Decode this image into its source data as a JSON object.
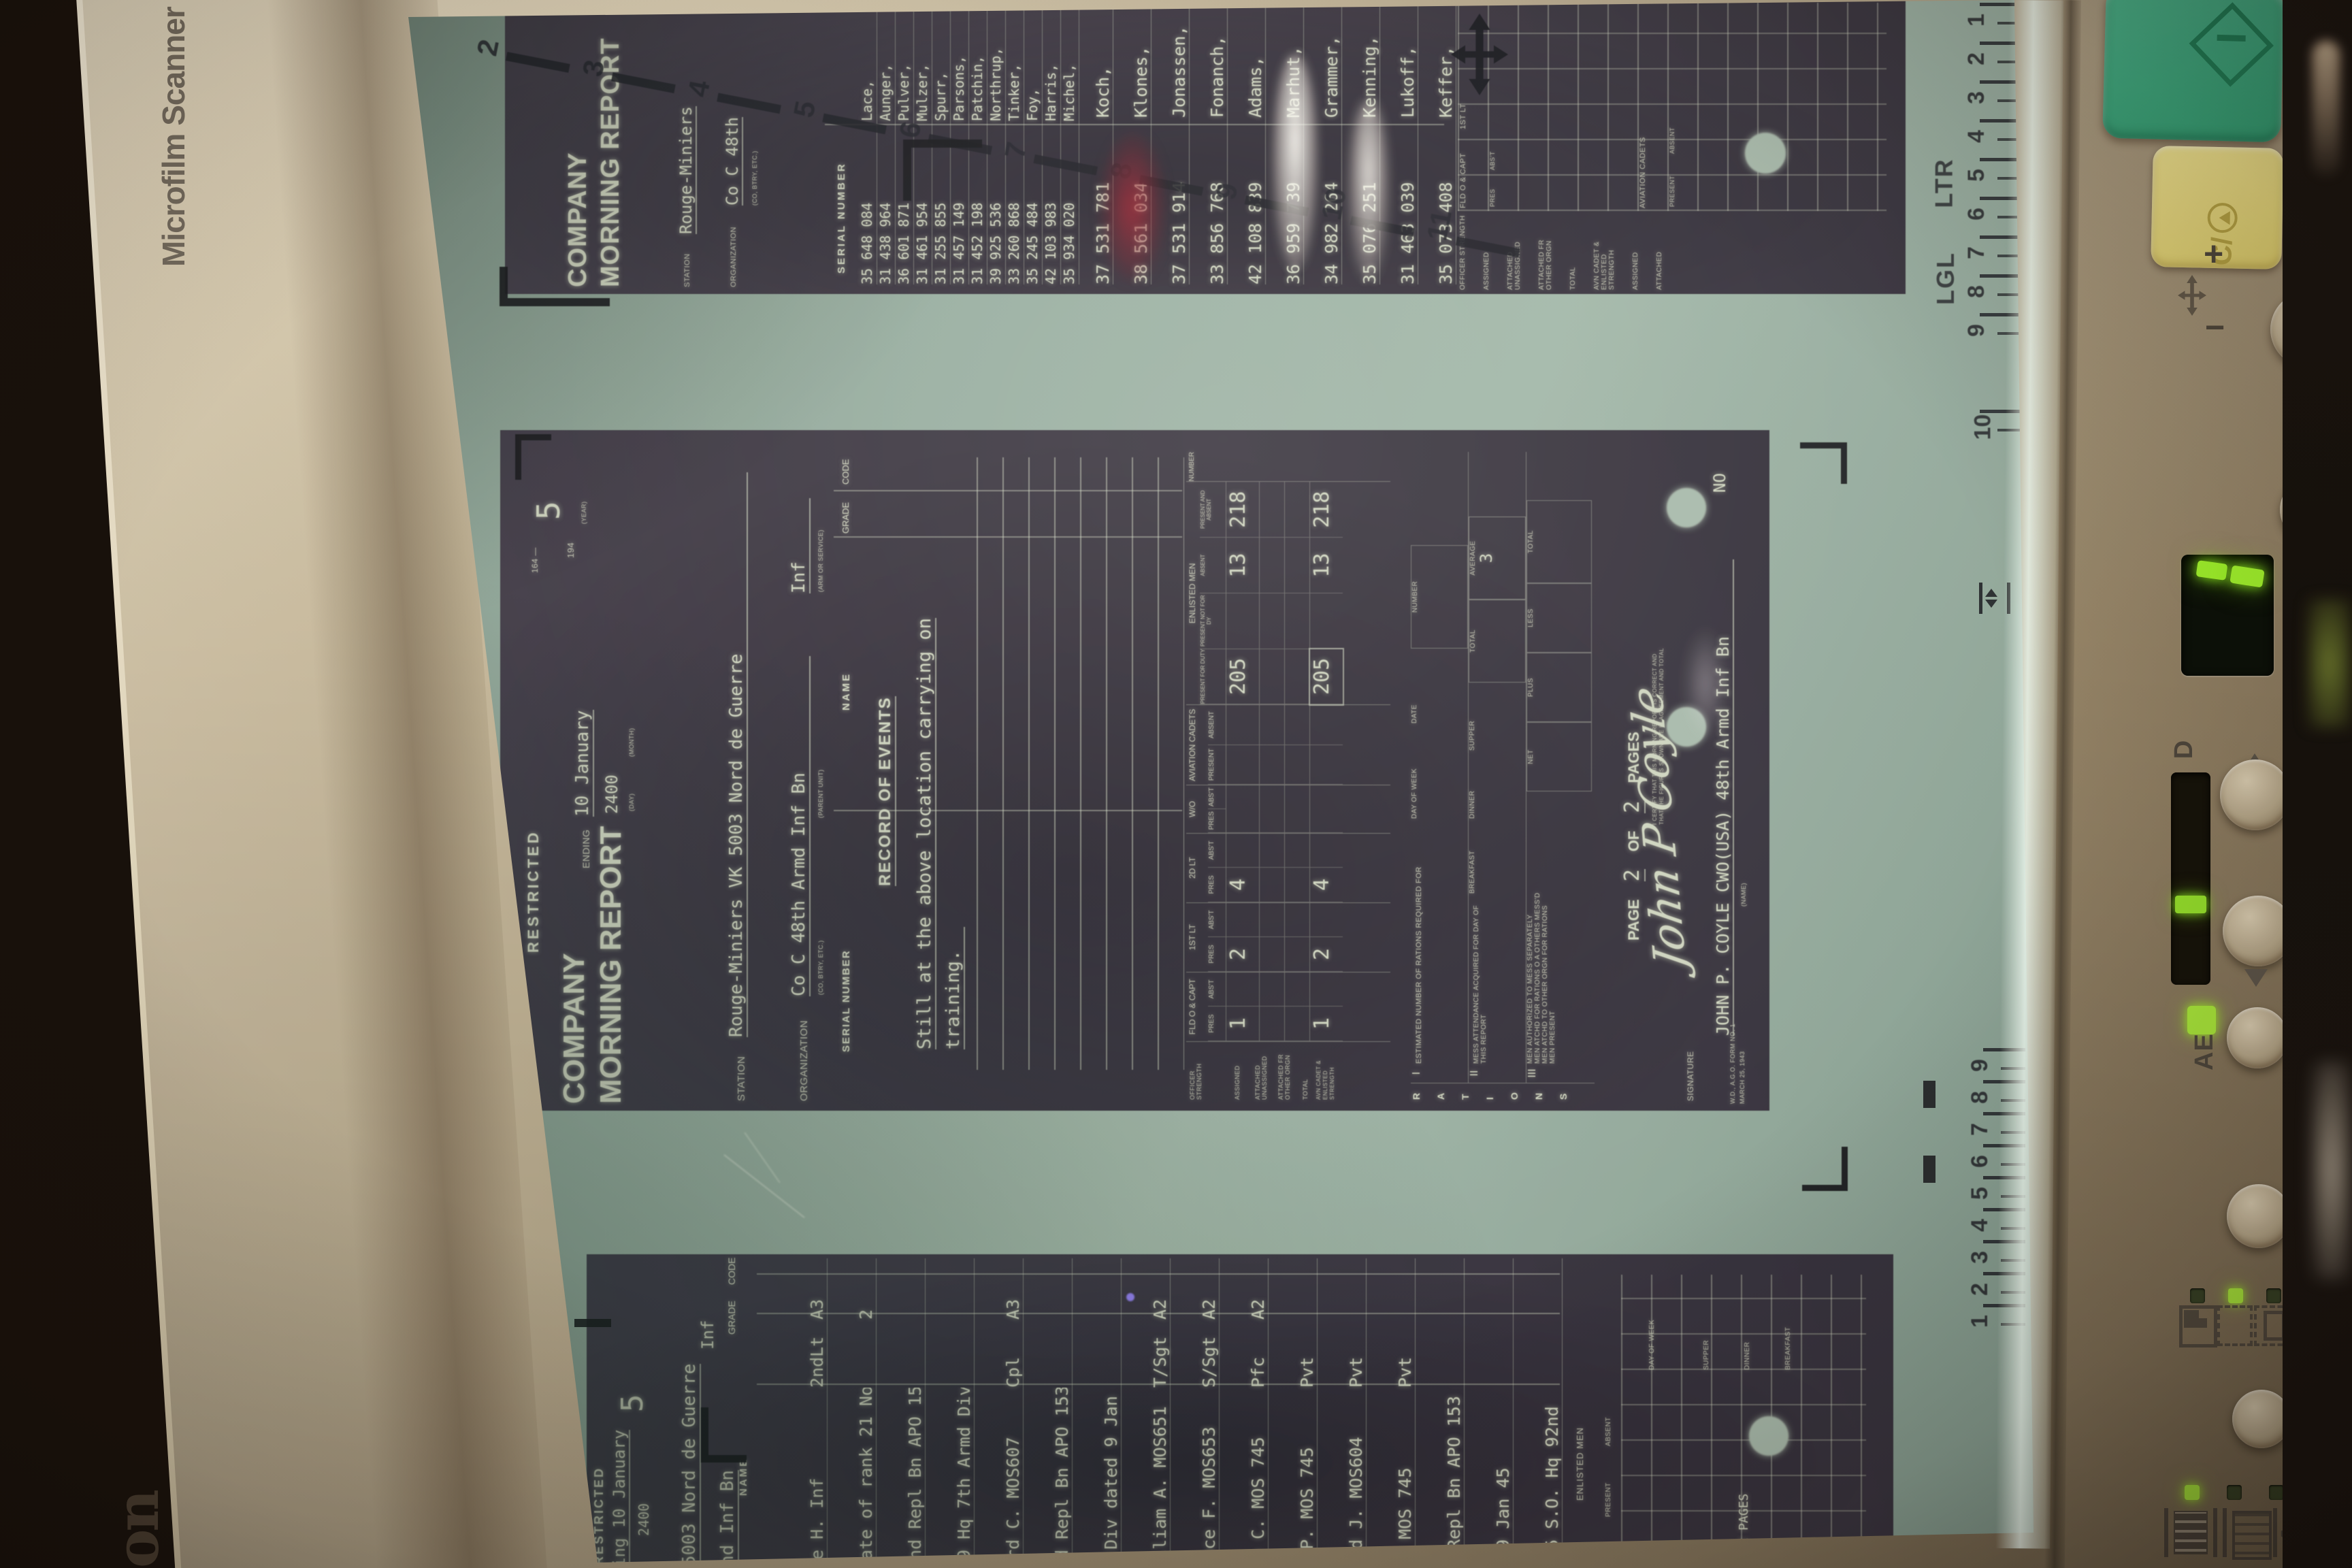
{
  "device": {
    "brand_strip": "Microfilm Scanner 30",
    "logo_partial": "on"
  },
  "rulers": {
    "top_digits": [
      "2",
      "3",
      "4",
      "5",
      "6",
      "7",
      "8",
      "9",
      "10",
      "11"
    ],
    "right_top": [
      "1",
      "2",
      "3",
      "4",
      "5",
      "6",
      "7",
      "8",
      "9"
    ],
    "right_mid": "10",
    "right_bottom": [
      "9",
      "8",
      "7",
      "6",
      "5",
      "4",
      "3",
      "2",
      "1"
    ],
    "ltr": "LTR",
    "lgl": "LGL"
  },
  "panel": {
    "clear_label": "C/",
    "plus": "+",
    "minus": "−",
    "d_label": "D",
    "ae_label": "AE",
    "auto_label": "A"
  },
  "screen": {
    "frames": {
      "top": {
        "title_line1": "COMPANY",
        "title_line2": "MORNING REPORT",
        "station_label": "STATION",
        "station_value": "Rouge-Miniers",
        "org_label": "ORGANIZATION",
        "org_value": "Co C 48th",
        "org_sub": "(CO, BTRY, ETC.)",
        "serial_header": "SERIAL NUMBER",
        "roster_dense": [
          {
            "s": "35 648 084",
            "n": "Lace,"
          },
          {
            "s": "31 438 964",
            "n": "Aunger,"
          },
          {
            "s": "36 601 871",
            "n": "Pulver,"
          },
          {
            "s": "31 461 954",
            "n": "Mulzer,"
          },
          {
            "s": "31 255 855",
            "n": "Spurr,"
          },
          {
            "s": "31 457 149",
            "n": "Parsons,"
          },
          {
            "s": "31 452 198",
            "n": "Patchin,"
          },
          {
            "s": "39 925 536",
            "n": "Northrup,"
          },
          {
            "s": "33 260 868",
            "n": "Tinker,"
          },
          {
            "s": "35 245 484",
            "n": "Foy,"
          },
          {
            "s": "42 103 983",
            "n": "Harris,"
          },
          {
            "s": "35 934 020",
            "n": "Michel,"
          }
        ],
        "roster_wide": [
          {
            "s": "37 531 781",
            "n": "Koch,"
          },
          {
            "s": "38 561 034",
            "n": "Klones,"
          },
          {
            "s": "37 531 914",
            "n": "Jonassen,"
          },
          {
            "s": "33 856 768",
            "n": "Fonanch,"
          },
          {
            "s": "42 108 839",
            "n": "Adams,"
          },
          {
            "s": "36 959 739",
            "n": "Marhut,"
          },
          {
            "s": "34 982 264",
            "n": "Grammer,"
          },
          {
            "s": "35 076 251",
            "n": "Kenning,"
          },
          {
            "s": "31 463 039",
            "n": "Lukoff,"
          },
          {
            "s": "35 073 408",
            "n": "Keffer,"
          }
        ],
        "strength_labels": [
          "OFFICER STRENGTH",
          "ASSIGNED",
          "ATTACHED UNASSIGNED",
          "ATTACHED FR OTHER ORGN",
          "TOTAL",
          "AVN CADET & ENLISTED STRENGTH",
          "ASSIGNED",
          "ATTACHED"
        ],
        "col1_title": "FLD O & CAPT",
        "col1_sub1": "PRES",
        "col1_sub2": "ABS'T",
        "col2_title": "1ST LT",
        "cadets_title": "AVIATION CADETS",
        "cadets_sub1": "PRESENT",
        "cadets_sub2": "ABSENT"
      },
      "middle": {
        "classification": "RESTRICTED",
        "title_line1": "COMPANY",
        "title_line2": "MORNING REPORT",
        "ending_label": "ENDING",
        "ending_value": "10 January",
        "ending_time": "2400",
        "day_label": "(DAY)",
        "month_label": "(MONTH)",
        "year_label": "(YEAR)",
        "form_small": "164 —",
        "year_prefix": "194",
        "year_value": "5",
        "station_label": "STATION",
        "station_value": "Rouge-Miniers VK 5003 Nord de Guerre",
        "org_label": "ORGANIZATION",
        "org_value": "Co C 48th Armd Inf Bn",
        "org_arm": "Inf",
        "org_sub1": "(CO, BTRY, ETC.)",
        "org_sub2": "(PARENT UNIT)",
        "org_sub3": "(ARM OR SERVICE)",
        "col_serial": "SERIAL NUMBER",
        "col_name": "NAME",
        "col_grade": "GRADE",
        "col_code": "CODE",
        "record_title": "RECORD OF EVENTS",
        "event_line1": "Still at the above location carrying on",
        "event_line2": "training.",
        "strength": {
          "row_label1": "ASSIGNED",
          "row_label2": "ATTACHED UNASSIGNED",
          "row_label3": "ATTACHED FR OTHER ORGN",
          "row_label4": "TOTAL",
          "band_label1": "OFFICER STRENGTH",
          "band_label2": "AVN CADET & ENLISTED STRENGTH",
          "c1": "FLD O & CAPT",
          "c2": "1ST LT",
          "c3": "2D LT",
          "c4": "W/O",
          "pres": "PRES",
          "abst": "ABS'T",
          "cadets": "AVIATION CADETS",
          "present": "PRESENT",
          "absent": "ABSENT",
          "em": "ENLISTED MEN",
          "em1": "PRESENT FOR DUTY",
          "em2": "PRESENT NOT FOR DY",
          "em3": "ABSENT",
          "em4": "PRESENT AND ABSENT",
          "number": "NUMBER",
          "a_fld": "1",
          "a_lt1": "2",
          "a_lt2": "4",
          "a_emd": "205",
          "a_ema": "13",
          "a_empa": "218",
          "t_fld": "1",
          "t_lt1": "2",
          "t_lt2": "4",
          "t_emd": "205",
          "t_ema": "13",
          "t_empa": "218"
        },
        "rations": {
          "letters": [
            "R",
            "A",
            "T",
            "I",
            "O",
            "N",
            "S"
          ],
          "r1_roman": "I",
          "r1_label": "ESTIMATED NUMBER OF RATIONS REQUIRED FOR",
          "r1c1": "DAY OF WEEK",
          "r1c2": "DATE",
          "r1c3": "NUMBER",
          "r2_roman": "II",
          "r2_label": "MESS ATTENDANCE ACQUIRED FOR DAY OF THIS REPORT",
          "meal1": "BREAKFAST",
          "meal2": "DINNER",
          "meal3": "SUPPER",
          "total_label": "TOTAL",
          "average_label": "AVERAGE",
          "average_value": "3",
          "r3_roman": "III",
          "r3a": "MEN AUTHORIZED TO MESS SEPARATELY",
          "r3b": "MEN ATCHD FOR RATIONS O A OTHERS MESS'D",
          "r3c": "MEN ATCHD TO OTHER ORGN FOR RATIONS",
          "r3d": "MEN PRESENT",
          "net": "NET",
          "plus": "PLUS",
          "less": "LESS",
          "total2": "TOTAL"
        },
        "footer": {
          "page_label": "PAGE",
          "page_value": "2",
          "of_label": "OF",
          "pages_value": "2",
          "pages_label": "PAGES",
          "cert1": "I CERTIFY THAT THIS MORNING REPORT IS CORRECT AND",
          "cert2": "THAT THE FIGURES SHOWN ARE IN AGREEMENT AND TOTAL",
          "signature_label": "SIGNATURE",
          "signature_script": "John P Coyle",
          "signature_typed": "JOHN P. COYLE  CWO(USA)  48th Armd Inf Bn",
          "no_value": "NO",
          "name_sub": "(NAME)",
          "form_id": "W.D., A.G.O. FORM NO. 1",
          "form_date": "MARCH 25, 1943"
        }
      },
      "bottom": {
        "classification": "RESTRICTED",
        "ending_fragment": "ing 10 January",
        "time": "2400",
        "year_value": "5",
        "station_fragment": "5003 Nord de Guerre",
        "org_fragment": "nd Inf Bn",
        "arm": "Inf",
        "grade": "GRADE",
        "code": "CODE",
        "name": "NAME",
        "rows": [
          {
            "n": "de H. Inf",
            "g": "2ndLt",
            "c": "A3"
          },
          {
            "n": "Date of rank 21 Nov44",
            "g": "",
            "c": "2"
          },
          {
            "n": "2nd Repl Bn APO 153",
            "g": "",
            "c": ""
          },
          {
            "n": "49 Hq 7th Armd Div",
            "g": "",
            "c": ""
          },
          {
            "n": "ard C. MOS607",
            "g": "Cpl",
            "c": "A3"
          },
          {
            "n": "nd Repl Bn APO 153",
            "g": "",
            "c": ""
          },
          {
            "n": "d Div dated 9 Jan 45",
            "g": "",
            "c": ""
          },
          {
            "n": "illiam A. MOS651",
            "g": "T/Sgt",
            "c": "A2"
          },
          {
            "n": "ence F. MOS653",
            "g": "S/Sgt",
            "c": "A2"
          },
          {
            "n": "ie C. MOS 745",
            "g": "Pfc",
            "c": "A2"
          },
          {
            "n": "l P. MOS 745",
            "g": "Pvt",
            "c": ""
          },
          {
            "n": "vid J. MOS604",
            "g": "Pvt",
            "c": ""
          },
          {
            "n": "M. MOS 745",
            "g": "Pvt",
            "c": ""
          },
          {
            "n": "d Repl Bn APO 153 per",
            "g": "",
            "c": ""
          },
          {
            "n": "d 9 Jan 45",
            "g": "",
            "c": ""
          },
          {
            "n": "r 5 S.O. Hq 92nd",
            "g": "",
            "c": ""
          }
        ],
        "em_title": "ENLISTED MEN",
        "present": "PRESENT",
        "absent": "ABSENT",
        "pages_fragment": "OF 2 PAGES",
        "day_of_week": "DAY OF WEEK",
        "supper": "SUPPER",
        "dinner": "DINNER",
        "breakfast": "BREAKFAST"
      }
    }
  }
}
